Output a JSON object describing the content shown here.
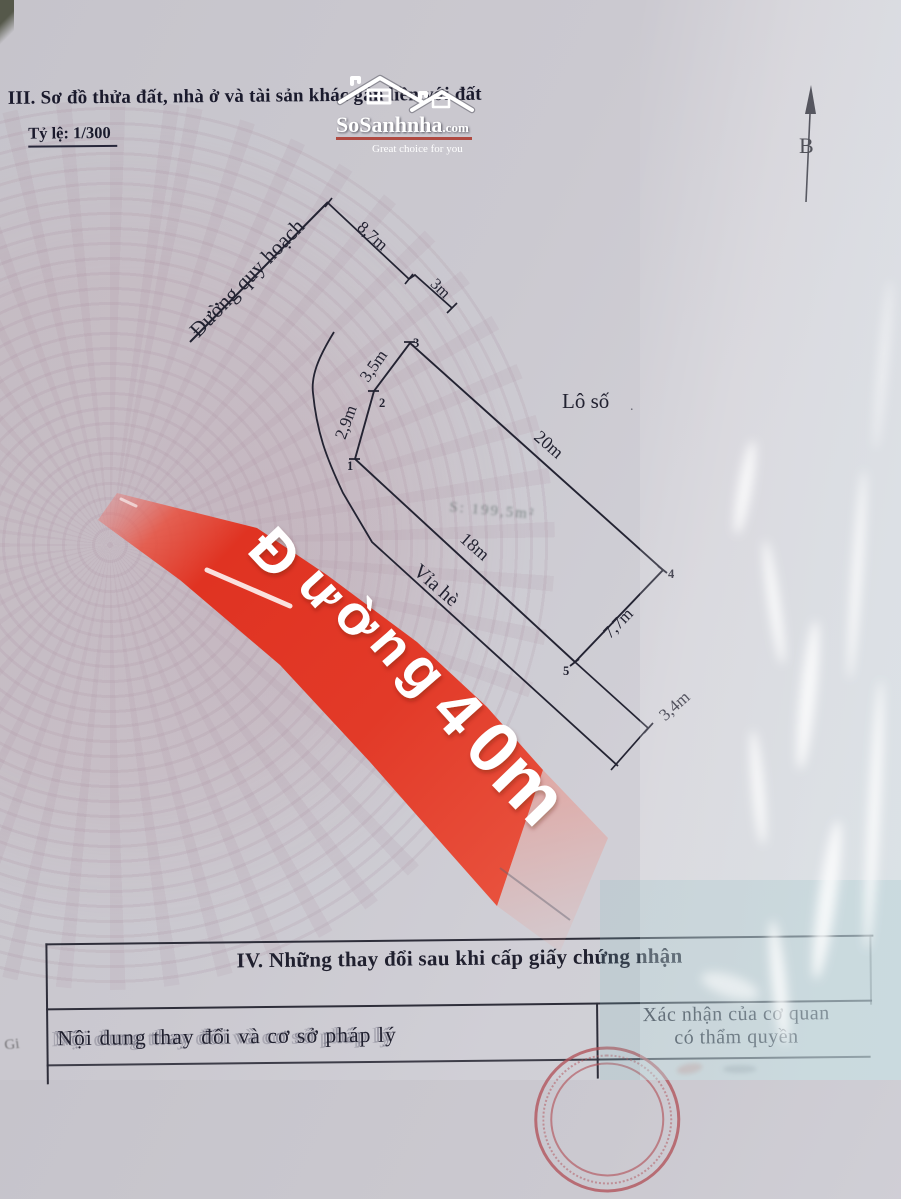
{
  "document": {
    "section3_title": "III. Sơ đồ thửa đất, nhà ở và tài sản khác gắn liền với đất",
    "scale_label": "Tỷ lệ: 1/300",
    "section4_title": "IV. Những thay đổi sau khi cấp giấy chứng nhận",
    "table": {
      "col_left_header": "Nội dung thay đổi và cơ sở pháp lý",
      "col_right_header_line1": "Xác nhận của cơ quan",
      "col_right_header_line2": "có thẩm quyền"
    },
    "margin_mark": "Gi"
  },
  "logo": {
    "brand": "SoSanhnha",
    "tld": ".com",
    "tagline": "Great choice for you"
  },
  "compass": {
    "label": "B"
  },
  "diagram": {
    "road_label": "Đường quy hoạch",
    "lot_label": "Lô số",
    "sidewalk_label": "Vỉa hè",
    "area_label": "S: 199,5m²",
    "dims": {
      "top1": "8,7m",
      "top2": "3m",
      "edge12": "2,9m",
      "edge23": "3,5m",
      "edge34": "20m",
      "edge45": "7,7m",
      "edge51": "18m",
      "ext5": "3,4m"
    },
    "vertices": [
      "1",
      "2",
      "3",
      "4",
      "5"
    ]
  },
  "banner": {
    "text": "Đường 40m",
    "color": "#e23a28"
  },
  "colors": {
    "paper": "#c8c6cd",
    "ink": "#232332",
    "banner_red": "#e23a28",
    "stamp_red": "#b2555c"
  }
}
